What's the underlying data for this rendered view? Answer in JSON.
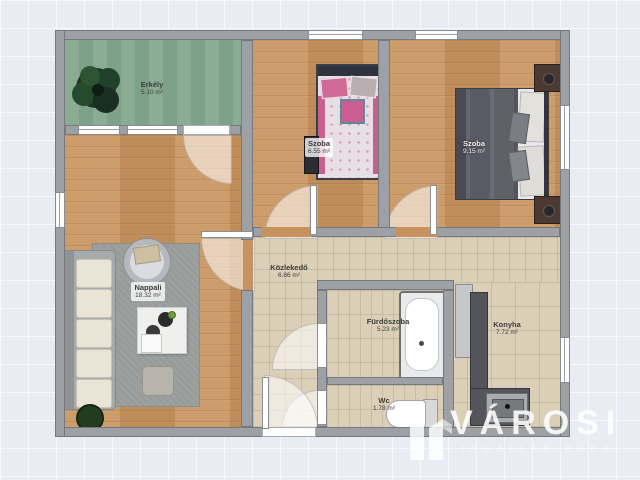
{
  "watermark": {
    "brand": "VÁROSI",
    "tagline": "INGATLANIRODA"
  },
  "rooms": {
    "balcony": {
      "name": "Erkély",
      "area": "5.10 m²"
    },
    "living": {
      "name": "Nappali",
      "area": "18.32 m²"
    },
    "bedroom_small": {
      "name": "Szoba",
      "area": "6.55 m²"
    },
    "bedroom_large": {
      "name": "Szoba",
      "area": "9.15 m²"
    },
    "hallway": {
      "name": "Közlekedő",
      "area": "6.86 m²"
    },
    "bathroom": {
      "name": "Fürdőszoba",
      "area": "5.23 m²"
    },
    "wc": {
      "name": "Wc",
      "area": "1.78 m²"
    },
    "kitchen": {
      "name": "Konyha",
      "area": "7.72 m²"
    }
  },
  "colors": {
    "wall": "#9da1a5",
    "wood_floor": "#c6935f",
    "tile_floor": "#dccfb8",
    "balcony_floor": "#84a88d",
    "accent_pink": "#c4618f",
    "background": "#e9ecf2"
  }
}
